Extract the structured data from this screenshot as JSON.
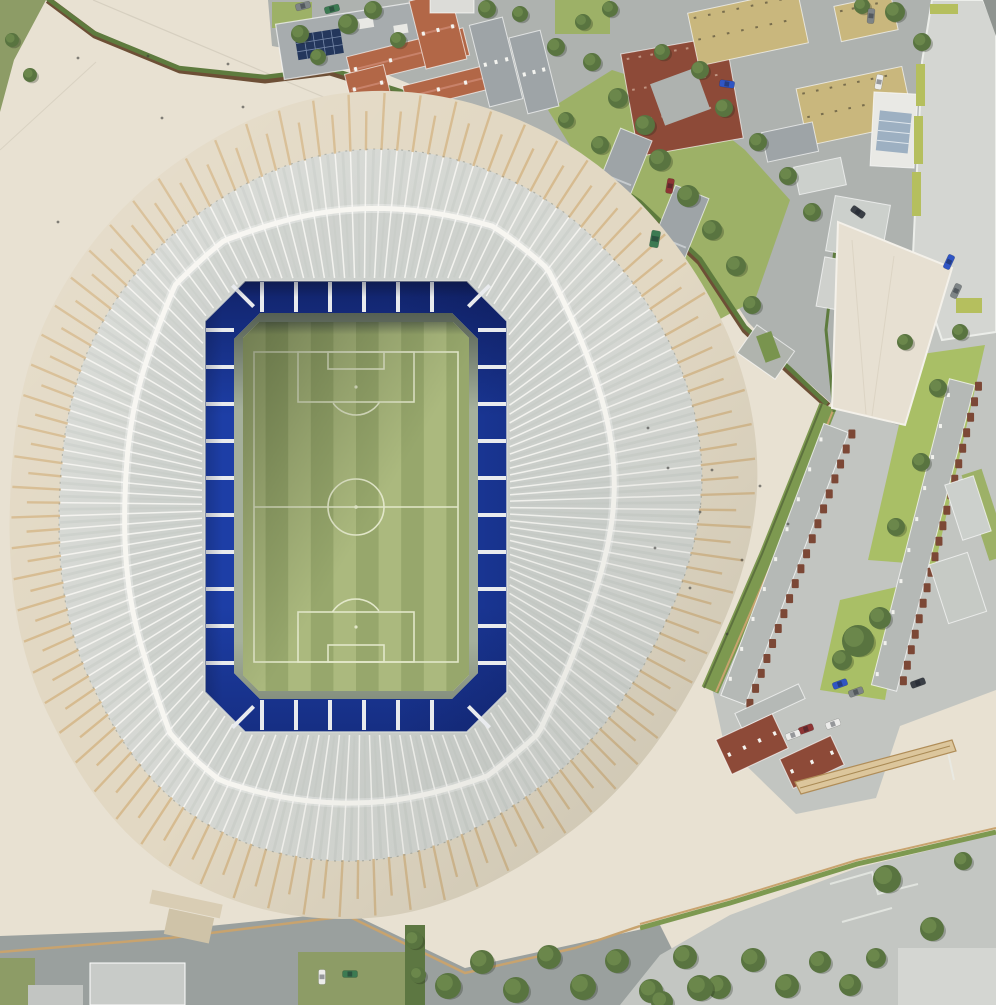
{
  "image": {
    "kind": "aerial-photograph-of-architectural-scale-model",
    "subject": "football-stadium-with-radial-roof-and-surrounding-city-blocks"
  },
  "stadium": {
    "roof_style": "radial-white-ribs-with-tan-outer-tips",
    "rib_count": 144,
    "concentric_ring": true,
    "seating_color": "#1d3ea6",
    "pitch_stripe_count": 10,
    "pitch_orientation": "vertical",
    "pitch_markings": [
      "touchlines",
      "goal-lines",
      "halfway-line",
      "centre-circle",
      "penalty-areas",
      "goal-areas",
      "penalty-arcs"
    ]
  },
  "surroundings": {
    "north": "terracotta-and-grey-roof-terraces, yellow-brick-blocks, garden-with-sheds, boundary-wall-with-hedge",
    "east": "brick-terrace-campus-with-green-courtyards, cream-wedge-roof-building",
    "south": "paved-esplanade, tree-row, grey-roads, low-grey-terrace",
    "cars_visible": 18,
    "trees_visible": 60
  },
  "palette": {
    "plaza": "#e8e1d2",
    "apron": "#e2d8c3",
    "roofLight": "#d8dad5",
    "roofMid": "#d2d5d1",
    "roofDark": "#c7ccc8",
    "rib": "#f6f5f1",
    "ribShadow": "#c4c9c3",
    "ribTan": "#d6ba8e",
    "ring": "#f7f6f1",
    "roofEdge": "#8a8f86",
    "seat": "#1d3ea6",
    "seatDark": "#0c1c5e",
    "divider": "#e9ebee",
    "walkway": "#a5b09c",
    "pitchA": "#abb97e",
    "pitchB": "#97a76c",
    "pitchLine": "#e2e7c9",
    "roadN": "#aeb2af",
    "roadS": "#9aa09e",
    "campus": "#c2c5c1",
    "terrace": "#c3c6c2",
    "paleBand": "#d4d6d2",
    "darkCorner": "#8f9490",
    "lawn": "#9db167",
    "lawnBright": "#a9bf66",
    "grass": "#8d9c66",
    "hedge": "#5e7b3e",
    "verge": "#7d9950",
    "wall": "#6d4f36",
    "tanLine": "#c8a36e",
    "tree": "#597440",
    "treeLight": "#6e8b4e",
    "brick": "#8d4a38",
    "brickMod": "#7c4836",
    "terracotta": "#b26747",
    "terracottaRidge": "#c8826a",
    "yellow": "#c9b77d",
    "bGray": "#a7acae",
    "bGrayRoof": "#9ea4a7",
    "bLight": "#ccd0cc",
    "bWhite": "#e9e9e5",
    "glass": "#9db0c2",
    "solar": "#24375c",
    "lime": "#b5bf5e",
    "rampTan": "#dcc69c",
    "rampEdge": "#b08d58",
    "bldSW": "#d9cdb4",
    "carBlue": "#2f55c4",
    "carRed": "#8e3434",
    "carWhite": "#ececea",
    "carGray": "#7e8486",
    "carGreen": "#3c7a52",
    "carDark": "#3a3f46",
    "speck": "#3a3a38",
    "white": "#f2f2ef"
  }
}
